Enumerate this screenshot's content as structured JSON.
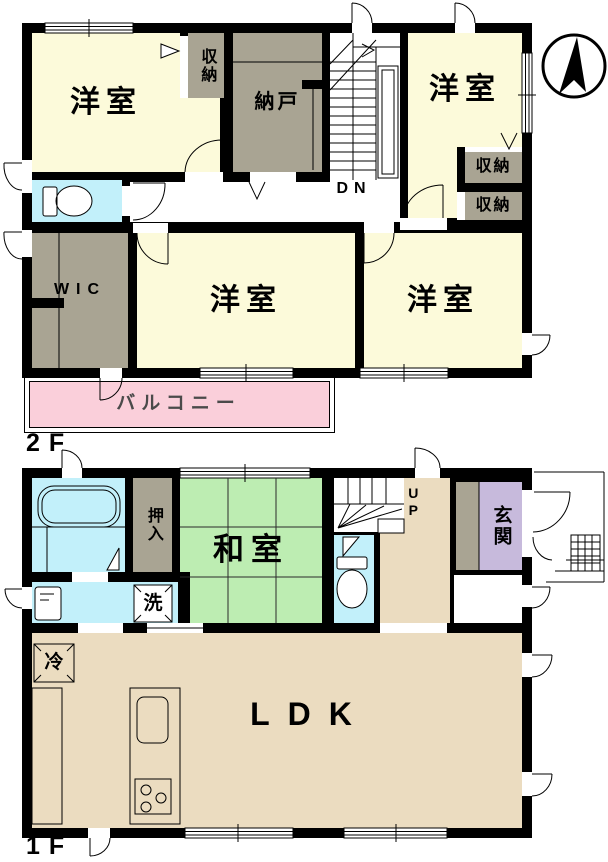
{
  "floor2": {
    "label": "2F",
    "rooms": {
      "yoshitsu_nw": "洋室",
      "shuno_n": "収納",
      "nando": "納戸",
      "stairs_dn": "DN",
      "yoshitsu_ne": "洋室",
      "shuno_e1": "収納",
      "shuno_e2": "収納",
      "wic": "WIC",
      "yoshitsu_s": "洋室",
      "yoshitsu_se": "洋室",
      "balcony": "バルコニー"
    }
  },
  "floor1": {
    "label": "1F",
    "rooms": {
      "oshiire": "押入",
      "washitsu": "和室",
      "laundry": "洗",
      "stairs_up": "UP",
      "genkan": "玄関",
      "fridge": "冷",
      "ldk": "LDK"
    }
  },
  "icons": {
    "compass": "north-arrow-icon"
  },
  "colors": {
    "room_cream": "#FCFADA",
    "closet_gray": "#A9A493",
    "water_cyan": "#C2F0FA",
    "tatami_green": "#BDEDB2",
    "ldk_tan": "#EBDCC0",
    "genkan_purple": "#C7BADC",
    "balcony_pink": "#FACFDA",
    "wall_black": "#000000"
  }
}
